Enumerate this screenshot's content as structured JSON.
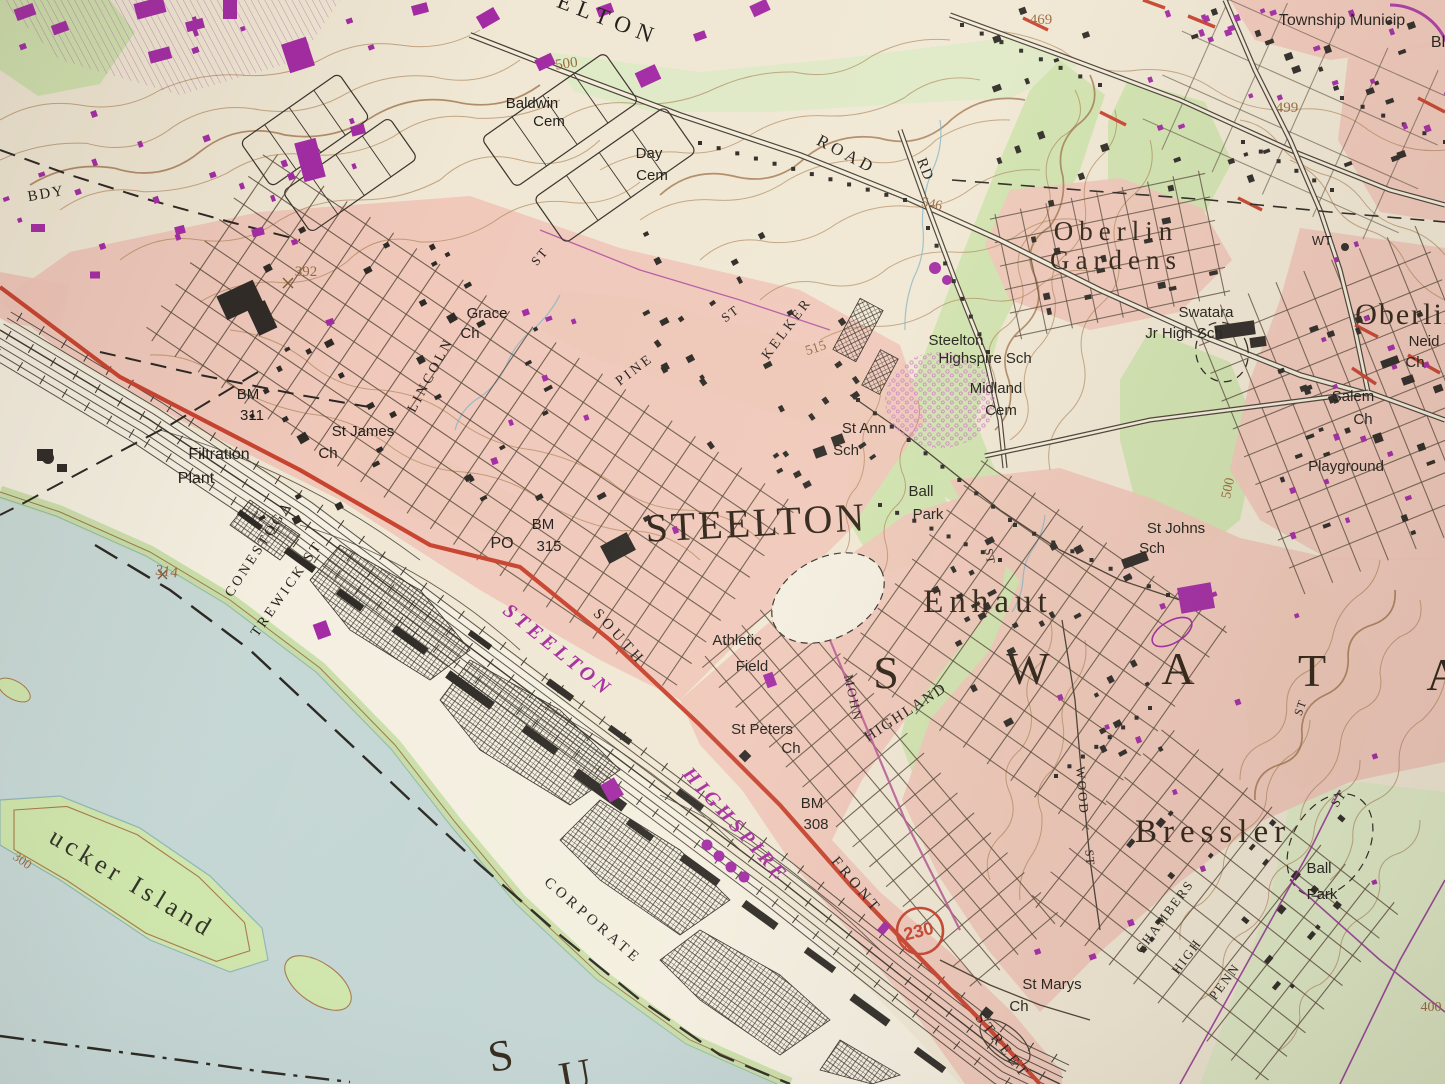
{
  "map": {
    "kind": "USGS topographic quadrangle (photo of paper map)",
    "primary_town": "STEELTON",
    "township_spaced_letters": [
      "S",
      "W",
      "A",
      "T",
      "A"
    ],
    "route_shield": {
      "number": "230"
    }
  },
  "colors": {
    "town": "#2f2317",
    "feature": "#211e1a",
    "street": "#241f1b",
    "contour": "#9a6b40",
    "rr": "#a62ba0",
    "red": "#c84531",
    "island": "#323428"
  },
  "labels": [
    {
      "t": "STEELTON",
      "x": 757,
      "y": 536,
      "r": -3,
      "s": 40,
      "f": "serif",
      "c": "town",
      "sp": 3
    },
    {
      "t": "S",
      "x": 886,
      "y": 688,
      "s": 46,
      "f": "serif",
      "c": "town"
    },
    {
      "t": "W",
      "x": 1028,
      "y": 684,
      "s": 46,
      "f": "serif",
      "c": "town"
    },
    {
      "t": "A",
      "x": 1178,
      "y": 684,
      "s": 46,
      "f": "serif",
      "c": "town"
    },
    {
      "t": "T",
      "x": 1312,
      "y": 686,
      "s": 46,
      "f": "serif",
      "c": "town"
    },
    {
      "t": "A",
      "x": 1443,
      "y": 690,
      "s": 46,
      "f": "serif",
      "c": "town"
    },
    {
      "t": "Enhaut",
      "x": 988,
      "y": 612,
      "s": 33,
      "f": "serif",
      "c": "town",
      "sp": 6
    },
    {
      "t": "Bressler",
      "x": 1213,
      "y": 842,
      "s": 33,
      "f": "serif",
      "c": "town",
      "sp": 6
    },
    {
      "t": "Oberlin",
      "x": 1116,
      "y": 240,
      "s": 27,
      "f": "serif",
      "c": "town",
      "sp": 6
    },
    {
      "t": "Gardens",
      "x": 1116,
      "y": 269,
      "s": 27,
      "f": "serif",
      "c": "town",
      "sp": 6
    },
    {
      "t": "Oberlin",
      "x": 1408,
      "y": 324,
      "s": 30,
      "f": "serif",
      "c": "town",
      "sp": 2
    },
    {
      "t": "S",
      "x": 503,
      "y": 1070,
      "r": -10,
      "s": 44,
      "f": "serif",
      "c": "town"
    },
    {
      "t": "U",
      "x": 578,
      "y": 1090,
      "r": -10,
      "s": 44,
      "f": "serif",
      "c": "town"
    },
    {
      "t": "ucker Island",
      "x": 128,
      "y": 890,
      "r": 31,
      "s": 26,
      "f": "serif",
      "c": "island",
      "sp": 5
    },
    {
      "t": "ELTON",
      "x": 606,
      "y": 26,
      "r": 21,
      "s": 23,
      "f": "serif",
      "c": "street",
      "sp": 7
    },
    {
      "t": "BDY",
      "x": 47,
      "y": 198,
      "r": -10,
      "s": 15,
      "f": "serif",
      "c": "street",
      "sp": 2
    },
    {
      "t": "Baldwin",
      "x": 532,
      "y": 108,
      "s": 15,
      "f": "sans",
      "c": "feature"
    },
    {
      "t": "Cem",
      "x": 549,
      "y": 126,
      "s": 15,
      "f": "sans",
      "c": "feature"
    },
    {
      "t": "Day",
      "x": 649,
      "y": 158,
      "s": 15,
      "f": "sans",
      "c": "feature"
    },
    {
      "t": "Cem",
      "x": 652,
      "y": 180,
      "s": 15,
      "f": "sans",
      "c": "feature"
    },
    {
      "t": "Grace",
      "x": 487,
      "y": 318,
      "s": 15,
      "f": "sans",
      "c": "feature"
    },
    {
      "t": "Ch",
      "x": 470,
      "y": 338,
      "s": 15,
      "f": "sans",
      "c": "feature"
    },
    {
      "t": "St James",
      "x": 363,
      "y": 436,
      "s": 15,
      "f": "sans",
      "c": "feature"
    },
    {
      "t": "Ch",
      "x": 328,
      "y": 458,
      "s": 15,
      "f": "sans",
      "c": "feature"
    },
    {
      "t": "Filtration",
      "x": 219,
      "y": 459,
      "s": 16,
      "f": "sans",
      "c": "feature"
    },
    {
      "t": "Plant",
      "x": 196,
      "y": 483,
      "s": 16,
      "f": "sans",
      "c": "feature"
    },
    {
      "t": "BM",
      "x": 248,
      "y": 399,
      "s": 15,
      "f": "sans",
      "c": "feature"
    },
    {
      "t": "311",
      "x": 252,
      "y": 420,
      "s": 15,
      "f": "sans",
      "c": "feature"
    },
    {
      "t": "BM",
      "x": 543,
      "y": 529,
      "s": 15,
      "f": "sans",
      "c": "feature"
    },
    {
      "t": "PO",
      "x": 502,
      "y": 548,
      "s": 16,
      "f": "sans",
      "c": "feature"
    },
    {
      "t": "315",
      "x": 549,
      "y": 551,
      "s": 15,
      "f": "sans",
      "c": "feature"
    },
    {
      "t": "BM",
      "x": 812,
      "y": 808,
      "s": 15,
      "f": "sans",
      "c": "feature"
    },
    {
      "t": "308",
      "x": 816,
      "y": 829,
      "s": 15,
      "f": "sans",
      "c": "feature"
    },
    {
      "t": "St Ann",
      "x": 864,
      "y": 433,
      "s": 15,
      "f": "sans",
      "c": "feature"
    },
    {
      "t": "Sch",
      "x": 846,
      "y": 455,
      "s": 15,
      "f": "sans",
      "c": "feature"
    },
    {
      "t": "Steelton",
      "x": 956,
      "y": 345,
      "s": 15,
      "f": "sans",
      "c": "feature"
    },
    {
      "t": "Highspire Sch",
      "x": 985,
      "y": 363,
      "s": 15,
      "f": "sans",
      "c": "feature"
    },
    {
      "t": "Midland",
      "x": 996,
      "y": 393,
      "s": 15,
      "f": "sans",
      "c": "feature"
    },
    {
      "t": "Cem",
      "x": 1001,
      "y": 415,
      "s": 15,
      "f": "sans",
      "c": "feature"
    },
    {
      "t": "Ball",
      "x": 921,
      "y": 496,
      "s": 15,
      "f": "sans",
      "c": "feature"
    },
    {
      "t": "Park",
      "x": 928,
      "y": 519,
      "s": 15,
      "f": "sans",
      "c": "feature"
    },
    {
      "t": "Ball",
      "x": 1319,
      "y": 873,
      "s": 15,
      "f": "sans",
      "c": "feature"
    },
    {
      "t": "Park",
      "x": 1322,
      "y": 899,
      "s": 15,
      "f": "sans",
      "c": "feature"
    },
    {
      "t": "St Johns",
      "x": 1176,
      "y": 533,
      "s": 15,
      "f": "sans",
      "c": "feature"
    },
    {
      "t": "Sch",
      "x": 1152,
      "y": 553,
      "s": 15,
      "f": "sans",
      "c": "feature"
    },
    {
      "t": "Swatara",
      "x": 1206,
      "y": 317,
      "s": 15,
      "f": "sans",
      "c": "feature"
    },
    {
      "t": "Jr High Sch",
      "x": 1184,
      "y": 338,
      "s": 15,
      "f": "sans",
      "c": "feature"
    },
    {
      "t": "Salem",
      "x": 1353,
      "y": 401,
      "s": 15,
      "f": "sans",
      "c": "feature"
    },
    {
      "t": "Ch",
      "x": 1363,
      "y": 424,
      "s": 15,
      "f": "sans",
      "c": "feature"
    },
    {
      "t": "Neid",
      "x": 1424,
      "y": 346,
      "s": 15,
      "f": "sans",
      "c": "feature"
    },
    {
      "t": "Ch",
      "x": 1415,
      "y": 367,
      "s": 15,
      "f": "sans",
      "c": "feature"
    },
    {
      "t": "Playground",
      "x": 1346,
      "y": 471,
      "s": 15,
      "f": "sans",
      "c": "feature"
    },
    {
      "t": "St Peters",
      "x": 762,
      "y": 734,
      "s": 15,
      "f": "sans",
      "c": "feature"
    },
    {
      "t": "Ch",
      "x": 791,
      "y": 753,
      "s": 15,
      "f": "sans",
      "c": "feature"
    },
    {
      "t": "St Marys",
      "x": 1052,
      "y": 989,
      "s": 15,
      "f": "sans",
      "c": "feature"
    },
    {
      "t": "Ch",
      "x": 1019,
      "y": 1011,
      "s": 15,
      "f": "sans",
      "c": "feature"
    },
    {
      "t": "Athletic",
      "x": 737,
      "y": 645,
      "s": 15,
      "f": "sans",
      "c": "feature"
    },
    {
      "t": "Field",
      "x": 752,
      "y": 671,
      "s": 15,
      "f": "sans",
      "c": "feature"
    },
    {
      "t": "Township Municip",
      "x": 1342,
      "y": 25,
      "s": 16,
      "f": "sans",
      "c": "feature"
    },
    {
      "t": "Bl",
      "x": 1438,
      "y": 47,
      "s": 16,
      "f": "sans",
      "c": "feature"
    },
    {
      "t": "WT",
      "x": 1322,
      "y": 245,
      "s": 13,
      "f": "sans",
      "c": "feature"
    },
    {
      "t": "LINCOLN",
      "x": 434,
      "y": 377,
      "r": -62,
      "s": 14,
      "f": "serif",
      "c": "street",
      "sp": 3
    },
    {
      "t": "ST",
      "x": 543,
      "y": 259,
      "r": -50,
      "s": 13,
      "f": "serif",
      "c": "street",
      "sp": 2
    },
    {
      "t": "PINE",
      "x": 637,
      "y": 373,
      "r": -37,
      "s": 14,
      "f": "serif",
      "c": "street",
      "sp": 3
    },
    {
      "t": "ST",
      "x": 733,
      "y": 317,
      "r": -37,
      "s": 13,
      "f": "serif",
      "c": "street",
      "sp": 2
    },
    {
      "t": "KELKER",
      "x": 790,
      "y": 331,
      "r": -53,
      "s": 14,
      "f": "serif",
      "c": "street",
      "sp": 3
    },
    {
      "t": "CONESTOGA",
      "x": 262,
      "y": 551,
      "r": -57,
      "s": 14,
      "f": "serif",
      "c": "street",
      "sp": 3
    },
    {
      "t": "TREWICK ST",
      "x": 290,
      "y": 591,
      "r": -55,
      "s": 14,
      "f": "serif",
      "c": "street",
      "sp": 3
    },
    {
      "t": "SOUTH",
      "x": 616,
      "y": 640,
      "r": 48,
      "s": 15,
      "f": "serif",
      "c": "street",
      "sp": 4
    },
    {
      "t": "FRONT",
      "x": 853,
      "y": 888,
      "r": 50,
      "s": 15,
      "f": "serif",
      "c": "street",
      "sp": 4
    },
    {
      "t": "STREET",
      "x": 999,
      "y": 1049,
      "r": 52,
      "s": 15,
      "f": "serif",
      "c": "street",
      "sp": 4
    },
    {
      "t": "CORPORATE",
      "x": 590,
      "y": 924,
      "r": 41,
      "s": 15,
      "f": "serif",
      "c": "street",
      "sp": 4
    },
    {
      "t": "MOHN",
      "x": 849,
      "y": 699,
      "r": 78,
      "s": 13,
      "f": "serif",
      "c": "street",
      "sp": 2
    },
    {
      "t": "HIGHLAND",
      "x": 908,
      "y": 716,
      "r": -33,
      "s": 15,
      "f": "serif",
      "c": "street",
      "sp": 2
    },
    {
      "t": "ST",
      "x": 986,
      "y": 557,
      "r": 80,
      "s": 12,
      "f": "serif",
      "c": "street",
      "sp": 1
    },
    {
      "t": "WOOD",
      "x": 1078,
      "y": 791,
      "r": 85,
      "s": 13,
      "f": "serif",
      "c": "street",
      "sp": 2
    },
    {
      "t": "ST",
      "x": 1086,
      "y": 858,
      "r": 85,
      "s": 12,
      "f": "serif",
      "c": "street",
      "sp": 1
    },
    {
      "t": "CHAMBERS",
      "x": 1168,
      "y": 919,
      "r": -53,
      "s": 13,
      "f": "serif",
      "c": "street",
      "sp": 2
    },
    {
      "t": "HIGH",
      "x": 1190,
      "y": 959,
      "r": -53,
      "s": 13,
      "f": "serif",
      "c": "street",
      "sp": 2
    },
    {
      "t": "PENN",
      "x": 1228,
      "y": 984,
      "r": -53,
      "s": 13,
      "f": "serif",
      "c": "street",
      "sp": 2
    },
    {
      "t": "ST",
      "x": 1342,
      "y": 801,
      "r": -55,
      "s": 13,
      "f": "serif",
      "c": "street",
      "sp": 1
    },
    {
      "t": "ST",
      "x": 1304,
      "y": 709,
      "r": -70,
      "s": 12,
      "f": "serif",
      "c": "street",
      "sp": 1
    },
    {
      "t": "ROAD",
      "x": 844,
      "y": 159,
      "r": 28,
      "s": 17,
      "f": "serif",
      "c": "street",
      "sp": 4
    },
    {
      "t": "RD",
      "x": 921,
      "y": 171,
      "r": 68,
      "s": 15,
      "f": "serif",
      "c": "street",
      "sp": 1
    },
    {
      "t": "STEELTON",
      "x": 554,
      "y": 655,
      "r": 39,
      "s": 20,
      "f": "rr",
      "c": "rr",
      "sp": 4
    },
    {
      "t": "HIGHSPIRE",
      "x": 731,
      "y": 829,
      "r": 48,
      "s": 20,
      "f": "rr",
      "c": "rr",
      "sp": 4
    },
    {
      "t": "500",
      "x": 567,
      "y": 68,
      "r": -8,
      "s": 15,
      "f": "serif",
      "c": "contour"
    },
    {
      "t": "515",
      "x": 817,
      "y": 352,
      "r": -18,
      "s": 14,
      "f": "serif",
      "c": "contour"
    },
    {
      "t": "499",
      "x": 1287,
      "y": 112,
      "s": 15,
      "f": "serif",
      "c": "contour"
    },
    {
      "t": "469",
      "x": 1041,
      "y": 24,
      "s": 15,
      "f": "serif",
      "c": "contour"
    },
    {
      "t": "392",
      "x": 306,
      "y": 276,
      "s": 15,
      "f": "serif",
      "c": "contour"
    },
    {
      "t": "314",
      "x": 166,
      "y": 576,
      "r": 8,
      "s": 15,
      "f": "serif",
      "c": "contour"
    },
    {
      "t": "500",
      "x": 1232,
      "y": 489,
      "r": -78,
      "s": 14,
      "f": "serif",
      "c": "contour"
    },
    {
      "t": "400",
      "x": 1431,
      "y": 1011,
      "s": 14,
      "f": "serif",
      "c": "contour"
    },
    {
      "t": "546",
      "x": 931,
      "y": 208,
      "r": 12,
      "s": 14,
      "f": "serif",
      "c": "contour"
    },
    {
      "t": "300",
      "x": 20,
      "y": 864,
      "r": 35,
      "s": 13,
      "f": "serif",
      "c": "contour"
    }
  ],
  "route_shield": {
    "number": "230",
    "x": 920,
    "y": 931
  }
}
